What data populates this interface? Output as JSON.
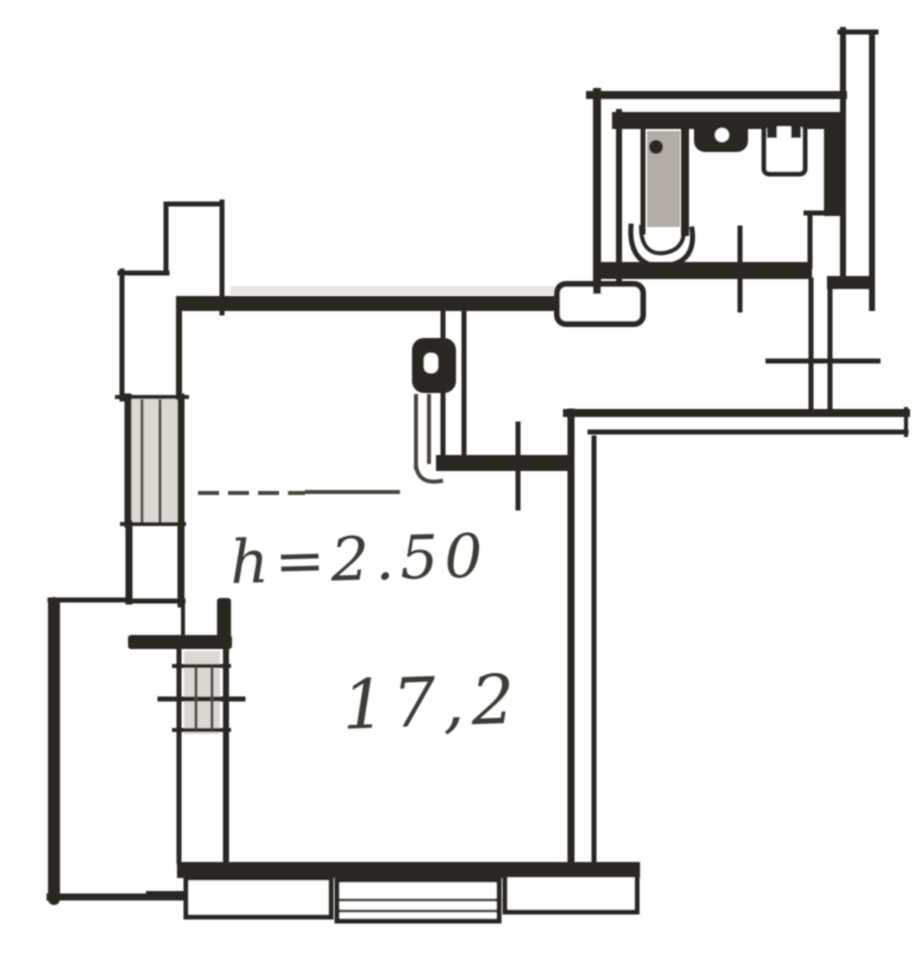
{
  "plan": {
    "room": {
      "height_label": "h=2.50",
      "area_label": "17,2"
    }
  },
  "colors": {
    "ink": "#2b2724",
    "ink_soft": "#4a443e",
    "paper": "#ffffff",
    "window_shade": "#dcd8d1",
    "tub_shade": "#b3ada5",
    "annotation": "#3e3a34"
  },
  "fixtures": {
    "bathtub": "bathtub-icon",
    "sink": "sink-icon",
    "faucet": "faucet-icon",
    "vent_shaft": "vent-shaft-icon",
    "door_opening": "door-opening-mark",
    "window": "window-mark"
  }
}
